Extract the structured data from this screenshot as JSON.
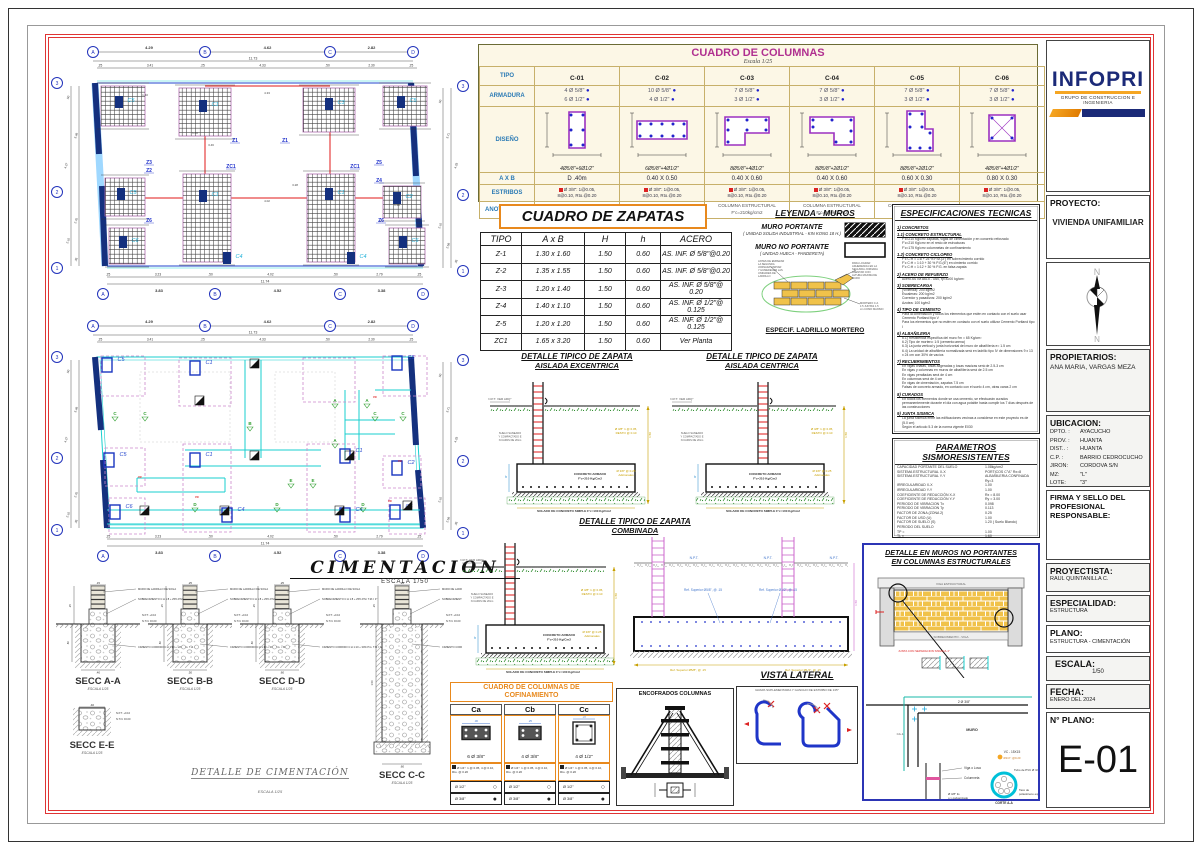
{
  "titleblock": {
    "logo": "INFOPRI",
    "logo_sub": "GRUPO DE CONSTRUCCION E INGENIERIA",
    "proyecto_label": "PROYECTO:",
    "proyecto": "VIVIENDA UNIFAMILIAR",
    "compass_n": "N",
    "propietarios_label": "PROPIETARIOS:",
    "propietarios": "ANA MARIA, VARGAS MEZA",
    "ubicacion_label": "UBICACION:",
    "ubicacion": [
      [
        "DPTO. :",
        "AYACUCHO"
      ],
      [
        "PROV. :",
        "HUANTA"
      ],
      [
        "DIST.. :",
        "HUANTA"
      ],
      [
        "C.P.  :",
        "BARRIO CEDROCUCHO"
      ],
      [
        "JIRON:",
        "CORDOVA S/N"
      ],
      [
        "MZ:",
        "\"L\""
      ],
      [
        "LOTE:",
        "\"3\""
      ]
    ],
    "firma_label": "FIRMA Y SELLO DEL PROFESIONAL RESPONSABLE:",
    "proyectista_label": "PROYECTISTA:",
    "proyectista": "RAUL QUINTANILLA C.",
    "especialidad_label": "ESPECIALIDAD:",
    "especialidad": "ESTRUCTURA",
    "plano_label": "PLANO:",
    "plano": "ESTRUCTURA - CIMENTACIÓN",
    "escala_label": "ESCALA:",
    "escala": "1/50",
    "fecha_label": "FECHA:",
    "fecha": "ENERO DEL 2024",
    "nplano_label": "N° PLANO:",
    "nplano": "E-01"
  },
  "cuadro_columnas": {
    "title": "CUADRO DE COLUMNAS",
    "subtitle": "Escala 1/25",
    "row_labels": [
      "TIPO",
      "ARMADURA",
      "DISEÑO",
      "A X B",
      "ESTRIBOS",
      "ANOTACIONES"
    ],
    "columns": [
      {
        "tipo": "C-01",
        "arm1": "4 Ø 5/8\"",
        "arm2": "6 Ø 1/2\"",
        "cap": "4Ø5/8\"+6Ø1/2\"",
        "axb": "D .40m",
        "est1": "Ø 3/8\": 1@0.05,",
        "est2": "8@0.10, Rto.@0.20",
        "anot1": "COLUMNA ESTRUCTURAL",
        "anot2": "F'c=210kg/cm2"
      },
      {
        "tipo": "C-02",
        "arm1": "10 Ø 5/8\"",
        "arm2": "4 Ø 1/2\"",
        "cap": "6Ø5/8\"+4Ø1/2\"",
        "axb": "0.40 X 0.50",
        "est1": "Ø 3/8\": 1@0.05,",
        "est2": "8@0.10, Rto.@0.20",
        "anot1": "COLUMNA ESTRUCTURAL",
        "anot2": "F'c=210kg/cm2"
      },
      {
        "tipo": "C-03",
        "arm1": "7 Ø 5/8\"",
        "arm2": "3 Ø 1/2\"",
        "cap": "8Ø5/8\"+4Ø1/2\"",
        "axb": "0.40 X 0.60",
        "est1": "Ø 3/8\": 1@0.05,",
        "est2": "8@0.10, Rto.@0.20",
        "anot1": "COLUMNA ESTRUCTURAL",
        "anot2": "F'c=210kg/cm2"
      },
      {
        "tipo": "C-04",
        "arm1": "7 Ø 5/8\"",
        "arm2": "3 Ø 1/2\"",
        "cap": "8Ø5/8\"+2Ø1/2\"",
        "axb": "0.40 X 0.60",
        "est1": "Ø 3/8\": 1@0.05,",
        "est2": "8@0.10, Rto.@0.20",
        "anot1": "COLUMNA ESTRUCTURAL",
        "anot2": "F'c=210kg/cm2"
      },
      {
        "tipo": "C-05",
        "arm1": "7 Ø 5/8\"",
        "arm2": "3 Ø 1/2\"",
        "cap": "8Ø5/8\"+2Ø1/2\"",
        "axb": "0.60 X 0.30",
        "est1": "Ø 3/8\": 1@0.05,",
        "est2": "8@0.10, Rto.@0.20",
        "anot1": "COLUMNA ESTRUCTURAL",
        "anot2": "F'c=210kg/cm2"
      },
      {
        "tipo": "C-06",
        "arm1": "7 Ø 5/8\"",
        "arm2": "3 Ø 1/2\"",
        "cap": "4Ø5/8\"+4Ø1/2\"",
        "axb": "0.80 X 0.30",
        "est1": "Ø 3/8\": 1@0.05,",
        "est2": "8@0.10, Rto.@0.20",
        "anot1": "COLUMNA ESTRUCTURAL",
        "anot2": "F'c=210kg/cm2"
      }
    ]
  },
  "cuadro_zapatas": {
    "title": "CUADRO DE ZAPATAS",
    "headers": [
      "TIPO",
      "A x B",
      "H",
      "h",
      "ACERO"
    ],
    "rows": [
      [
        "Z-1",
        "1.30 x 1.60",
        "1.50",
        "0.60",
        "AS. INF. Ø 5/8\"@0.20"
      ],
      [
        "Z-2",
        "1.35 x 1.55",
        "1.50",
        "0.60",
        "AS. INF. Ø 5/8\"@0.20"
      ],
      [
        "Z-3",
        "1.20 x 1.40",
        "1.50",
        "0.60",
        "AS. INF. Ø 5/8\"@ 0.20"
      ],
      [
        "Z-4",
        "1.40 x 1.10",
        "1.50",
        "0.60",
        "AS. INF. Ø 1/2\"@ 0.125"
      ],
      [
        "Z-5",
        "1.20 x 1.20",
        "1.50",
        "0.60",
        "AS. INF. Ø 1/2\"@ 0.125"
      ],
      [
        "ZC1",
        "1.65 x 3.20",
        "1.50",
        "0.60",
        "Ver Planta"
      ]
    ]
  },
  "leyenda": {
    "title": "LEYENDA - MUROS",
    "item1": "MURO PORTANTE",
    "item1_sub": "( UNIDAD SOLIDA INDUSTRIAL - KIN KONG 18 H.)",
    "item2": "MURO NO PORTANTE",
    "item2_sub": "( UNIDAD HUECA - PANDERETA)",
    "nota_izq": "ANTES DE EMPEZAR LA SEGUNDA JORNADA LIMPIAR Y HUMEDECER LAS UNIDADES DE LADRILLO",
    "nota_der": "PARA LOGRAR ADHERENCIA EN LA SEGUNDA JORNADA ASENTAR CON ALTURA MAXIMA DE MURO",
    "nota_mortero": "MORTERO C:A 1:5 JUNTAS 1.5 cm COMO MAXIMO",
    "especif": "ESPECIF. LADRILLO MORTERO"
  },
  "especificaciones": {
    "title": "ESPECIFICACIONES TECNICAS",
    "secciones": [
      {
        "h": "1) CONCRETOS",
        "lines": []
      },
      {
        "h": "1.1) CONCRETO ESTRUCTURAL",
        "lines": [
          "F'c=210 Kg/cm² zapatas, vigas de cimentación y en concreto reforzado",
          "F'c=210 Kg/cm² en el resto de estructuras",
          "F'c=175 Kg/cm² columnetas de confinamiento"
        ]
      },
      {
        "h": "1.2) CONCRETO CICLOPEO",
        "lines": [
          "F'c  C:H = 1:8 + 25 % P.M.(3\") en sobrecimiento corrido",
          "F'c  C:H = 1:10 + 30 % P.G.(6\") en cimiento corrido",
          "F'c  C:H = 1:12 + 30 % P.G. en falsa zapata"
        ]
      },
      {
        "h": "2) ACERO DE REFUERZO",
        "lines": [
          "Acero ASTM A615 - G60,  fy=4200 kg/cm²"
        ]
      },
      {
        "h": "3) SOBRECARGA",
        "lines": [
          "(Vivienda): 200 kg/m2",
          "Escaleras: 200 kg/m2",
          "Corredor y pasadizos: 200 kg/m2",
          "Azotea: 100 kg/m2"
        ]
      },
      {
        "h": "4) TIPO DE CEMENTO",
        "lines": [
          "Para la cimentación y todos los elementos que estén en contacto con el suelo usar Cemento Portland tipo V",
          "Para los elementos que no estén en contacto con el suelo utilizar Cemento Portland tipo I"
        ]
      },
      {
        "h": "6) ALBAÑILERIA",
        "lines": [
          "6.1) Resistencia específica del muro f'm = 65 Kg/cm²",
          "6.2) Tipo de mortero: 1:5 (cemento:arena)",
          "6.3) La junta vertical y junta horizontal del muro de albañilería e= 1.5 cm",
          "6.4) La unidad de albañilería normalizada será en ladrillo tipo IV de dimensiones 9 x 13 x 24 cm con 30% de vacíos"
        ]
      },
      {
        "h": "7) RECUBRIMIENTOS",
        "lines": [
          "En vigas chatas, losas aligeradas y losas macizas será de 2.5-3 cm",
          "En vigas y columnas en muros de albañilería será de 2.5 cm",
          "En vigas peraltadas será de 4 cm",
          "En columnas será de 4 cm",
          "En vigas de cimentación, zapatas 7.5 cm",
          "Falsas de concreto armado, en contacto con el suelo 4 cm, otras caras 2 cm"
        ]
      },
      {
        "h": "8) CURADOS",
        "lines": [
          "En todos los elementos donde se usa cemento, se efectuarán curados permanentemente durante el día con agua potable hasta cumplir los 7 días después de las construcciones"
        ]
      },
      {
        "h": "9) JUNTA SISMICA",
        "lines": [
          "La junta sísmica entre las edificaciones vecinas a considerar en este proyecto es de (5.0 cm)",
          "Según el artículo 5.3 de la norma vigente E030"
        ]
      }
    ]
  },
  "parametros": {
    "title": "PARAMETROS SISMORESISTENTES",
    "rows": [
      [
        "CAPACIDAD PORTANTE DEL SUELO",
        "1.08kg/cm2"
      ],
      [
        "SISTEMA ESTRUCTURAL X-X",
        "PORTICOS C°A°   Rx=8"
      ],
      [
        "SISTEMA ESTRUCTURAL Y-Y",
        "ALBAÑILERIA CONFINADA  Ry=3"
      ],
      [
        "IRREGULARIDAD  X-X",
        "1.00"
      ],
      [
        "IRREGULARIDAD  Y-Y",
        "1.00"
      ],
      [
        "COEFICIENTE DE REDUCCIÓN X-X",
        "Rx = 8.00"
      ],
      [
        "COEFICIENTE DE REDUCCIÓN Y-Y",
        "Ry = 3.00"
      ],
      [
        "PERIODO DE VIBRACION Tx",
        "0.098"
      ],
      [
        "PERIODO DE VIBRACION Ty",
        "0.113"
      ],
      [
        "FACTOR DE ZONA (ZONA 2)",
        "0.25"
      ],
      [
        "FACTOR DE USO (U)",
        "1.00"
      ],
      [
        "FACTOR DE SUELO (S)",
        "1.20 ( Suelo Blando)"
      ],
      [
        "PERIODO DEL SUELO",
        ""
      ],
      [
        "      TP =",
        "1.00"
      ],
      [
        "      TL =",
        "1.60"
      ],
      [
        "CORTANTE DISEÑO X-X",
        "86.148 Tonf"
      ],
      [
        "CORTANTE DISEÑO Y-Y",
        "214.283 Tonf"
      ],
      [
        "MAX DESPLAZAMIENTO INELASTICO X-X",
        "0.00004m"
      ],
      [
        "MAX DESPLAZAMIENTO INELASTICO Y-Y",
        "0.00109m"
      ]
    ]
  },
  "plans": {
    "axes_top": [
      "A",
      "B",
      "C",
      "D"
    ],
    "axes_side": [
      "3",
      "2",
      "1"
    ],
    "top_dims": [
      "4.29",
      "4.62",
      "2.82"
    ],
    "top_total": "11.73",
    "top_subdims": [
      ".25",
      "3.41",
      ".25",
      "4.33",
      ".50",
      "2.30",
      ".25"
    ],
    "bottom_subdims": [
      ".25",
      "3.23",
      ".50",
      "4.02",
      ".50",
      "2.79",
      ".25"
    ],
    "bottom_total": "11.74",
    "bottom_dims": [
      "3.83",
      "4.52",
      "3.38"
    ],
    "left_dims": [
      ".50",
      "3.48",
      "4.27",
      "2.70",
      "2.10",
      ".35"
    ],
    "right_dims": [
      ".50",
      "3.71",
      "4.33",
      "2.10",
      "2.58",
      ".35"
    ],
    "inner_dims": [
      "1.40",
      "1.60",
      "4.33",
      "3.46",
      "4.02",
      "3.28",
      "1.20"
    ],
    "zapata_tags": [
      "Z3",
      "Z1",
      "Z1",
      "Z5",
      "Z2",
      "ZC1",
      "ZC1",
      "Z4",
      "Z6",
      "Z6"
    ],
    "col_tags_top": [
      "C5",
      "C1",
      "C3",
      "C5"
    ],
    "col_tags_mid": [
      "C5",
      "C1",
      "C1",
      "C2"
    ],
    "col_tags_bot": [
      "C6",
      "C4",
      "C4",
      "C6"
    ],
    "section_marks": [
      "A",
      "B",
      "C",
      "D",
      "E"
    ],
    "vc_mark": "VC",
    "title": "CIMENTACION",
    "title_scale": "ESCALA 1/50"
  },
  "sections": {
    "titles": [
      "SECC A-A",
      "SECC B-B",
      "SECC D-D",
      "SECC C-C",
      "SECC E-E"
    ],
    "scale": "ESCALA 1/25",
    "top_dims": [
      ".15",
      ".25",
      ".25",
      ".25",
      ".25"
    ],
    "base_dims": [
      ".40",
      ".50",
      ".60",
      ".60",
      ".40"
    ],
    "lbl_muro": "MURO DE LADRILLO DE SOGA",
    "lbl_sobre": "SOBRECIMIENTO C:H 1:8 + 25% P.M. T.M.= 3\"",
    "lbl_npt": "N.P.T. +0.10",
    "lbl_ntn": "N.T.N. ±0.00",
    "lbl_cim": "CIMIENTO CORRIDO C:H 1:10 + 30% P.G. T.M.= 6\"",
    "detalle_title": "DETALLE  DE CIMENTACIÓN",
    "detalle_scale": "ESCALA 1/25"
  },
  "detalles_zapata": {
    "t1a": "DETALLE TIPICO DE ZAPATA",
    "t1b": "AISLADA EXCENTRICA",
    "t2a": "DETALLE TIPICO DE ZAPATA",
    "t2b": "AISLADA CENTRICA",
    "t3a": "DETALLE TIPICO DE ZAPATA",
    "t3b": "COMBINADA",
    "npt_ver": "N.P.T. VER ARQ°",
    "npt": "N.P.T.",
    "suelo": "SUELO SANEADO Y COMPACTADO EN CAPAS DE 20cm",
    "concreto": "CONCRETO ARMADO F'c=210 Kg/Cm2",
    "solado": "SOLADO DE CONCRETO SIMPLE F'c=100 Kg/Cm2",
    "est1": "Ø 3/8\" 1 @ 0.05,",
    "est1b": "RESTO @ 0.10",
    "est2": "Ø 3/8\" @ 0.25",
    "est2b": "Adicionales",
    "h_dim": "1.50",
    "hh_dim": "0.60",
    "h_letter": "h",
    "b_dim": "A x B",
    "ref_sup_58": "Ref. Superior Ø5/8\", @ .15",
    "ref_sup_12": "Ref. Superior Ø1/2\", @ .15"
  },
  "muros_detalle": {
    "t1": "DETALLE  EN MUROS NO PORTANTES",
    "t2": "EN COLUMNAS ESTRUCTURALES",
    "viga": "VIGA ESTRUCTURAL",
    "sobrecimiento": "SOBRECIMIENTO - VIGA",
    "junta": "JUNTA CON SEPARACION SISMICA 1\"",
    "dosbarras": "2 Ø 3/8\"",
    "muro": "MURO",
    "ca1": "CA-1",
    "vc": "VC - 15X15",
    "vc_est": "Ø1/4\": @0.20",
    "viga_losa": "Viga o Losa",
    "columneta": "Columneta",
    "liso": "Ø 3/8\" liso y galvanizado",
    "tubo": "Tubo de PVC Ø 3/4\"",
    "taco": "Taco de poliestireno expandido",
    "corte": "CORTE A-A"
  },
  "confinamiento": {
    "title1": "CUADRO DE COLUMNAS DE",
    "title2": "COFINAMIENTO",
    "cols": [
      {
        "name": "Ca",
        "acero": "6 Ø 3/8\"",
        "est": "Ø 1/4\": 1 @ 0.05, 4 @ 0.10, Rto. @ 0.20"
      },
      {
        "name": "Cb",
        "acero": "4 Ø 3/8\"",
        "est": "Ø 1/4\": 1 @ 0.05, 4 @ 0.10, Rto. @ 0.20"
      },
      {
        "name": "Cc",
        "acero": "4 Ø 1/2\"",
        "est": "Ø 1/4\": 1 @ 0.05, 4 @ 0.10, Rto. @ 0.20"
      }
    ],
    "leg1": "Ø 1/2\"",
    "leg2": "Ø 3/8\""
  },
  "encofrados": {
    "title": "ENCOFRADOS COLUMNAS"
  },
  "vista_lateral": {
    "title": "VISTA LATERAL",
    "caption": "GRAPA SUPLEMENTARIA Y GANCHO DE ESTRIBO DE 135°"
  }
}
